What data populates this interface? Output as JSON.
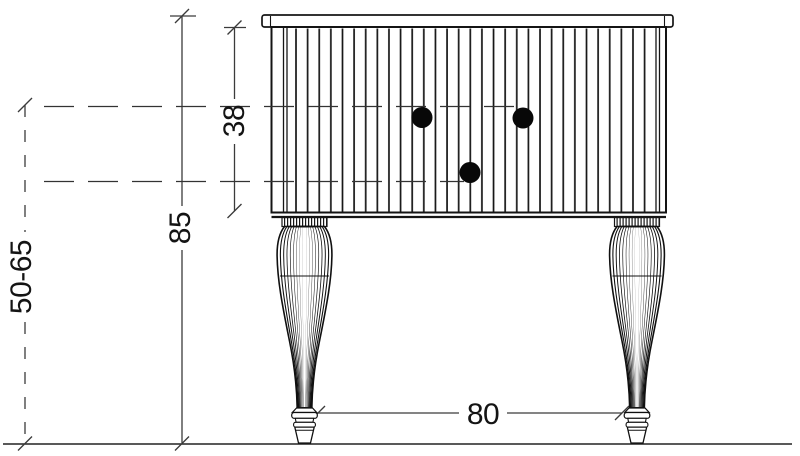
{
  "dimensions": {
    "box_height": "38",
    "total_height": "85",
    "floor_range": "50-65",
    "width": "80"
  },
  "colors": {
    "ink": "#141414",
    "dimension_line": "#3b3b3b",
    "background": "#ffffff"
  }
}
